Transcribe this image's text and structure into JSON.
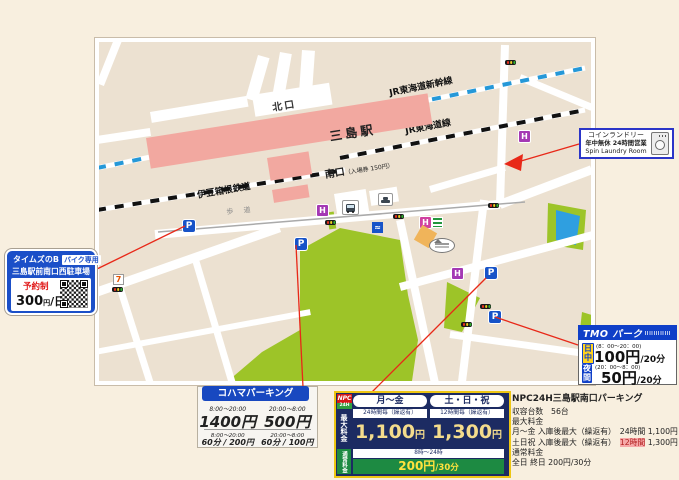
{
  "station": {
    "name": "三島駅",
    "north_exit": "北口",
    "south_exit": "南口",
    "south_exit_note": "（入場券 150円）",
    "shinkansen_label": "JR東海道新幹線",
    "jr_label": "JR東海道線",
    "izuhakone_label": "伊豆箱根鉄道",
    "walkway_label": "歩 道",
    "parking_symbol": "P",
    "hotel_symbol": "H",
    "seven_symbol": "7",
    "landmark_symbol": "≈"
  },
  "times_b": {
    "brand": "タイムズのB",
    "badge": "バイク専用",
    "name": "三島駅前南口西駐車場",
    "reservation": "予約制",
    "price": "300",
    "price_unit": "円",
    "per": "/日"
  },
  "laundry": {
    "line1": "コインランドリー",
    "line2": "年中無休 24時間営業",
    "line3": "Spin Laundry Room"
  },
  "tmo": {
    "title": "TMO パーク",
    "day_badge": "日中",
    "day_hours": "(8：00～20：00)",
    "day_price": "100円",
    "day_per": "/20分",
    "night_badge": "夜間",
    "night_hours": "(20：00～8：00)",
    "night_price": "50円",
    "night_per": "/20分"
  },
  "kohama": {
    "title": "コハマパーキング",
    "day_hours": "8:00～20:00",
    "day_price": "1400円",
    "night_hours": "20:00～8:00",
    "night_price": "500円",
    "day_hours2": "8:00～20:00",
    "day_rate": "60分 / 200円",
    "night_hours2": "20:00～8:00",
    "night_rate": "60分 / 100円"
  },
  "npc_table": {
    "logo_top": "NPC",
    "logo_bottom": "24H",
    "col_weekday": "月～金",
    "col_weekend": "土・日・祝",
    "max_label": "最大料金",
    "sub_weekday": "24時間毎（繰返有）",
    "sub_weekend": "12時間毎（繰返有）",
    "price_weekday": "1,100",
    "price_weekday_unit": "円",
    "price_weekend": "1,300",
    "price_weekend_unit": "円",
    "normal_label": "通常料金",
    "normal_hours": "8時～24時",
    "normal_rate": "200円",
    "normal_rate_per": "/30分"
  },
  "npc_details": {
    "title": "NPC24H三島駅南口パーキング",
    "line_capacity": "収容台数　56台",
    "line_max_label": "最大料金",
    "line_weekday": "月～金 入庫後最大（繰返有）　24時間 1,100円",
    "line_weekend_pre": "土日祝 入庫後最大（繰返有）　",
    "line_weekend_highlight": "12時間",
    "line_weekend_post": " 1,300円",
    "line_normal_label": "通常料金",
    "line_normal": "全日 終日 200円/30分"
  }
}
